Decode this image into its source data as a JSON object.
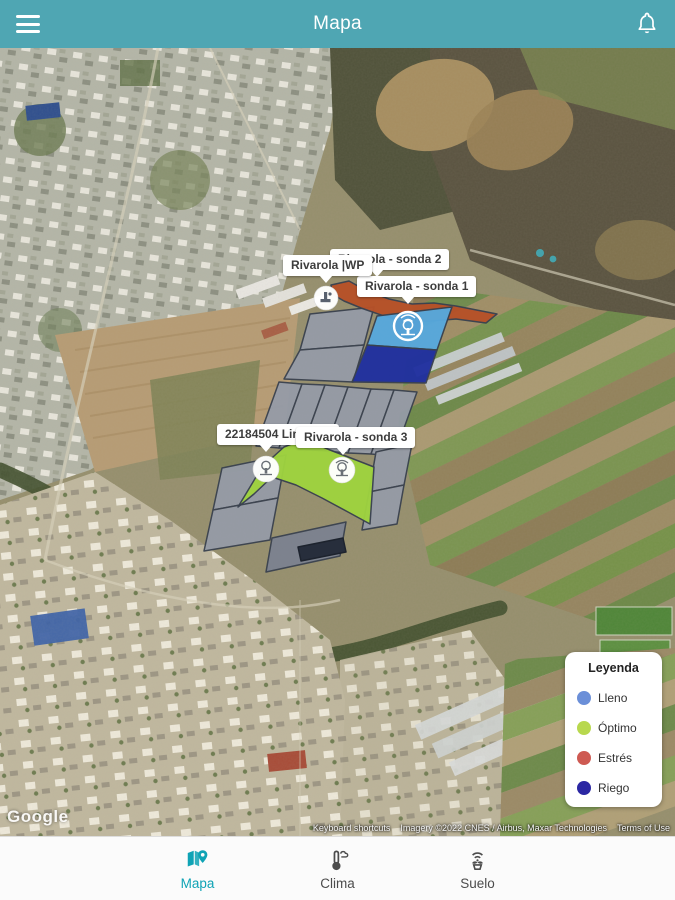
{
  "header": {
    "title": "Mapa"
  },
  "icons": {
    "menu": "hamburger-menu",
    "notifications": "bell",
    "marker_wp": "water-pump-marker",
    "marker_probe": "tree-sensor-marker",
    "nav_map": "map-with-pin",
    "nav_climate": "thermometer-cloud",
    "nav_soil": "plant-signal"
  },
  "map": {
    "field_labels": [
      {
        "name": "sonda2",
        "text": "Rivarola - sonda 2"
      },
      {
        "name": "wp",
        "text": "Rivarola |WP"
      },
      {
        "name": "sonda1",
        "text": "Rivarola - sonda 1"
      },
      {
        "name": "limones",
        "text": "22184504 Limones"
      },
      {
        "name": "sonda3",
        "text": "Rivarola - sonda 3"
      }
    ],
    "watermark": "Google",
    "attribution": {
      "keyboard_shortcuts": "Keyboard shortcuts",
      "imagery": "Imagery ©2022 CNES / Airbus, Maxar Technologies",
      "terms_of_use": "Terms of Use"
    }
  },
  "legend": {
    "title": "Leyenda",
    "items": [
      {
        "label": "Lleno",
        "color": "#6b8fd8"
      },
      {
        "label": "Óptimo",
        "color": "#b8d84e"
      },
      {
        "label": "Estrés",
        "color": "#ce5a52"
      },
      {
        "label": "Riego",
        "color": "#2b27a3"
      }
    ]
  },
  "nav": {
    "active": "Mapa",
    "items": [
      {
        "label": "Mapa"
      },
      {
        "label": "Clima"
      },
      {
        "label": "Suelo"
      }
    ]
  },
  "colors": {
    "app_bar": "#4fa6b3",
    "active_tab": "#0fa3b5",
    "field_lleno": "#57a8dd",
    "field_optimo": "#9ed23f",
    "field_estres": "#b65028",
    "field_riego": "#1f2f9f",
    "parcel_gray": "#959ba7"
  }
}
